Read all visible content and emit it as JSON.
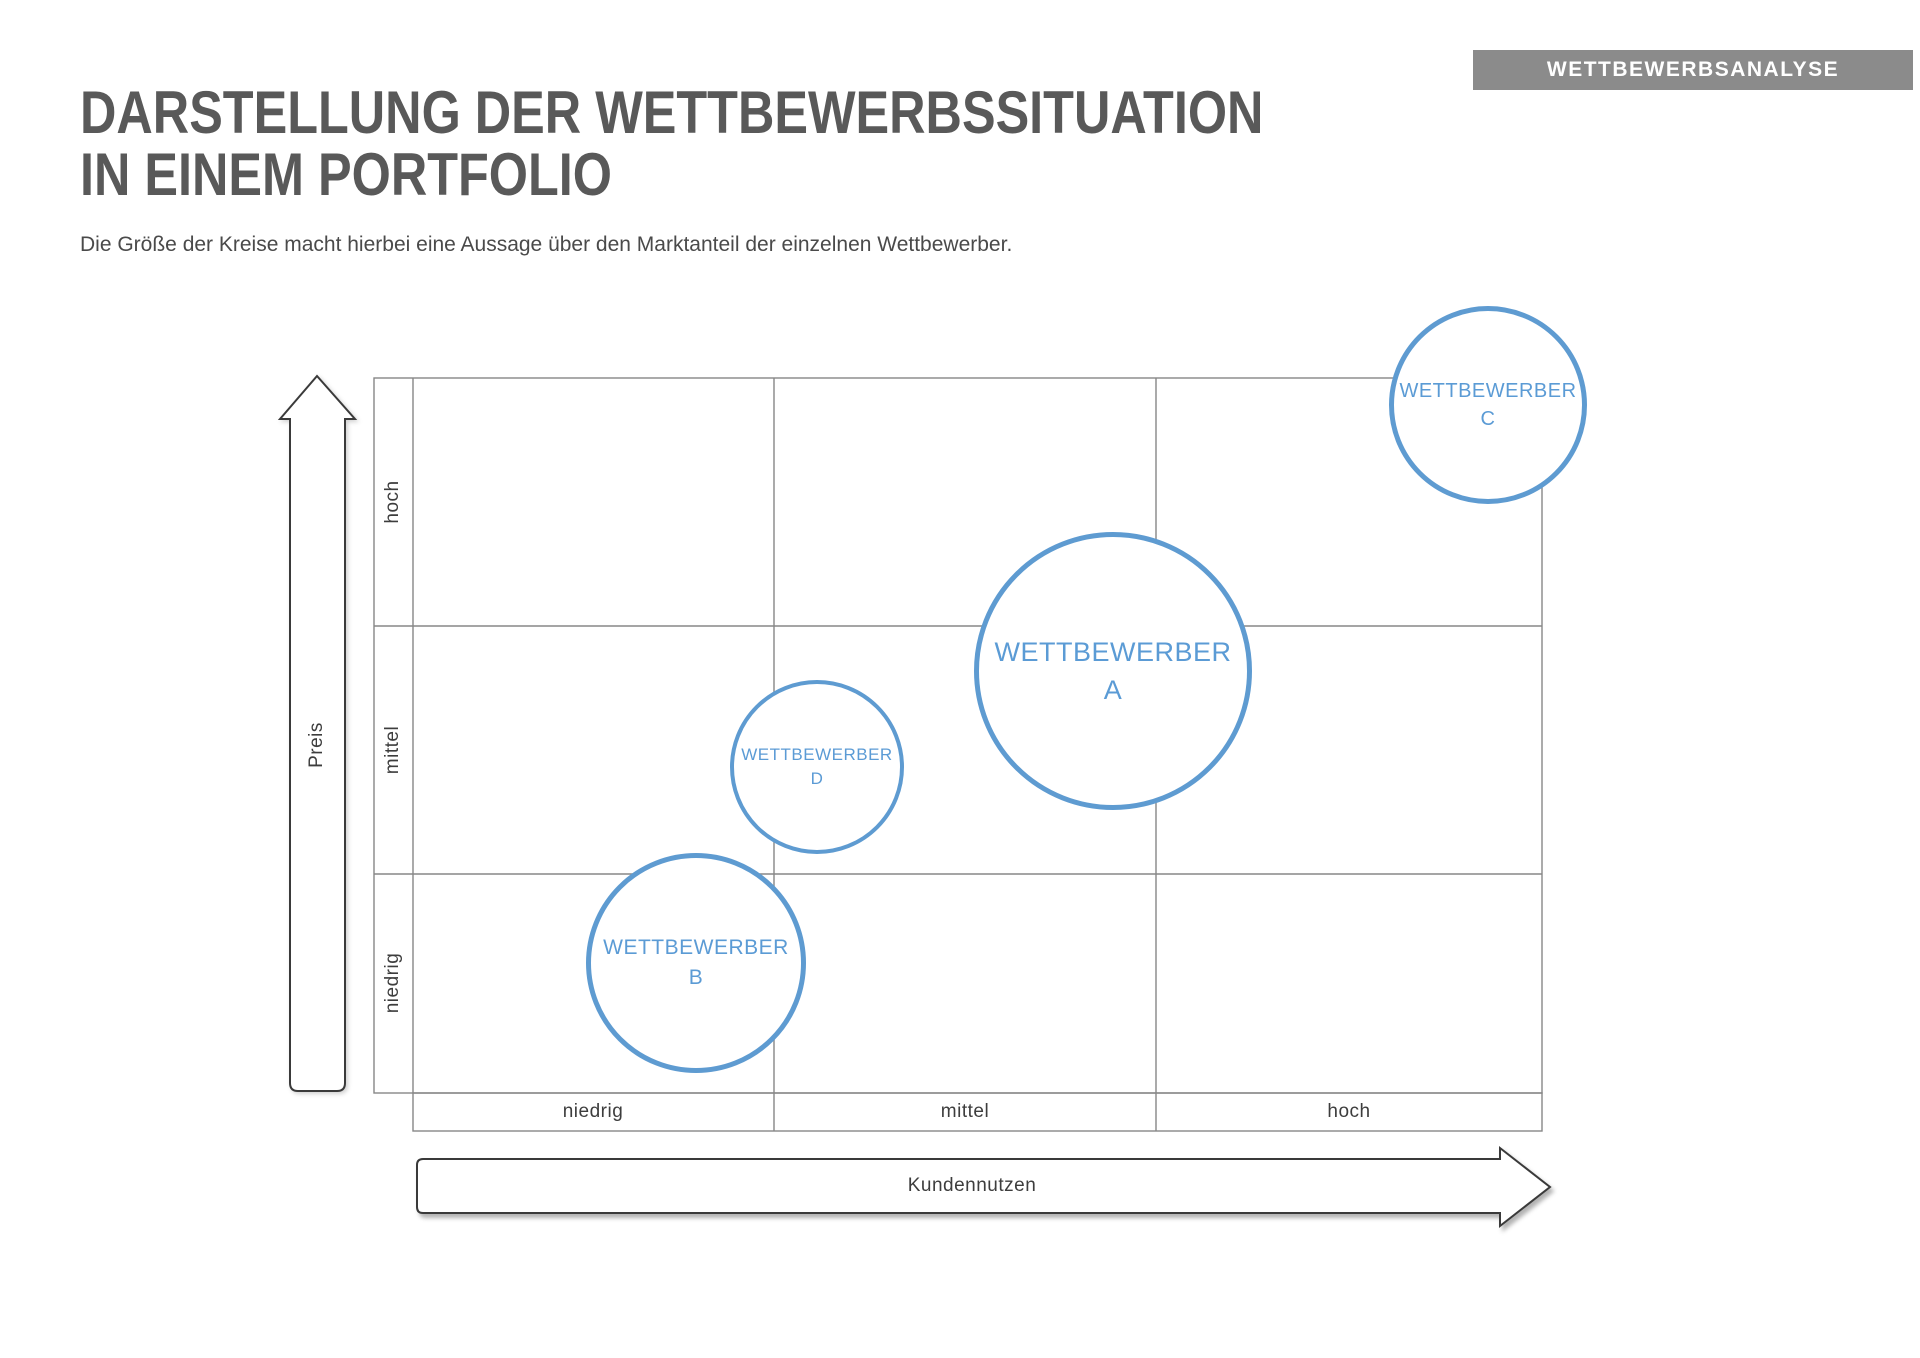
{
  "badge": {
    "label": "WETTBEWERBSANALYSE"
  },
  "header": {
    "title_line1": "DARSTELLUNG DER WETTBEWERBSSITUATION",
    "title_line2": "IN EINEM PORTFOLIO",
    "subtitle": "Die Größe der Kreise macht hierbei eine Aussage über den Marktanteil der einzelnen Wettbewerber."
  },
  "colors": {
    "accent_blue_stroke": "#5E9BD1",
    "bubble_text_blue": "#5B9BD5",
    "grid_gray": "#878787",
    "arrow_outline": "#3A3A3A",
    "badge_gray": "#8B8B8B",
    "title_gray": "#595959"
  },
  "chart_data": {
    "type": "scatter",
    "subtype": "bubble-portfolio-matrix",
    "grid": "3x3",
    "size_meaning": "Marktanteil (Größe der Kreise)",
    "x_axis": {
      "title": "Kundennutzen",
      "categories": [
        "niedrig",
        "mittel",
        "hoch"
      ],
      "direction": "arrow-right",
      "range_units": [
        0,
        3
      ]
    },
    "y_axis": {
      "title": "Preis",
      "categories_top_to_bottom": [
        "hoch",
        "mittel",
        "niedrig"
      ],
      "direction": "arrow-up",
      "range_units": [
        0,
        3
      ]
    },
    "bubbles": [
      {
        "company": "WETTBEWERBER",
        "letter": "A",
        "kundennutzen": "mittel (nahe hoch)",
        "preis": "mittel (oberer Bereich)",
        "x_units": 1.89,
        "y_units": 1.82,
        "marktanteil_rank": 1,
        "cx": 1113,
        "cy": 671,
        "r": 139,
        "stroke_px": 5.5,
        "font_px": 27
      },
      {
        "company": "WETTBEWERBER",
        "letter": "B",
        "kundennutzen": "niedrig",
        "preis": "niedrig",
        "x_units": 0.78,
        "y_units": 0.59,
        "marktanteil_rank": 2,
        "cx": 696,
        "cy": 963,
        "r": 110,
        "stroke_px": 5.5,
        "font_px": 21
      },
      {
        "company": "WETTBEWERBER",
        "letter": "C",
        "kundennutzen": "hoch",
        "preis": "hoch",
        "x_units": 2.86,
        "y_units": 2.89,
        "marktanteil_rank": 3,
        "cx": 1488,
        "cy": 405,
        "r": 99,
        "stroke_px": 5,
        "font_px": 20
      },
      {
        "company": "WETTBEWERBER",
        "letter": "D",
        "kundennutzen": "mittel (unterer Bereich)",
        "preis": "mittel",
        "x_units": 1.11,
        "y_units": 1.43,
        "marktanteil_rank": 4,
        "cx": 817,
        "cy": 767,
        "r": 87,
        "stroke_px": 4.5,
        "font_px": 17
      }
    ]
  }
}
